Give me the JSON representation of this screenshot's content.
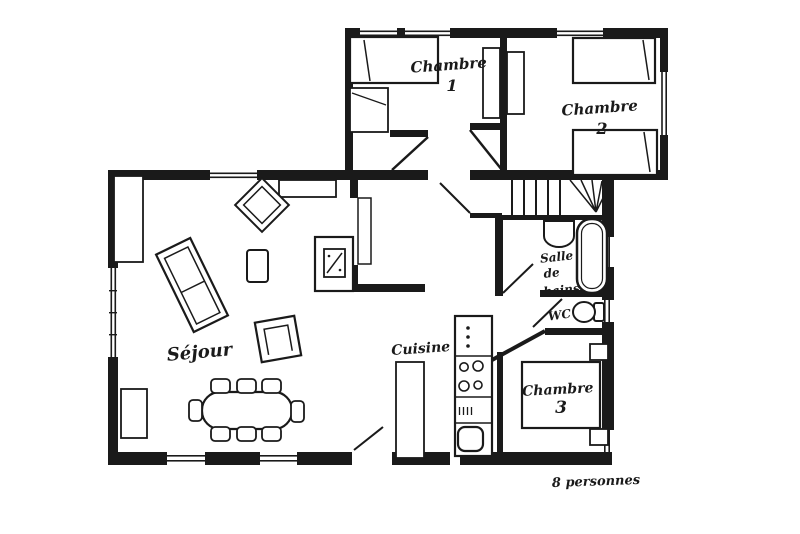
{
  "rooms": {
    "chambre1": {
      "name": "Chambre",
      "number": "1"
    },
    "chambre2": {
      "name": "Chambre",
      "number": "2"
    },
    "chambre3": {
      "name": "Chambre",
      "number": "3"
    },
    "sejour": {
      "name": "Séjour"
    },
    "cuisine": {
      "name": "Cuisine"
    },
    "salle_de_bains": {
      "line1": "Salle",
      "line2": "de",
      "line3": "bains"
    },
    "wc": {
      "name": "WC"
    }
  },
  "annotations": {
    "capacity": "8 personnes"
  },
  "colors": {
    "ink": "#1a1a1a",
    "paper": "#ffffff"
  }
}
